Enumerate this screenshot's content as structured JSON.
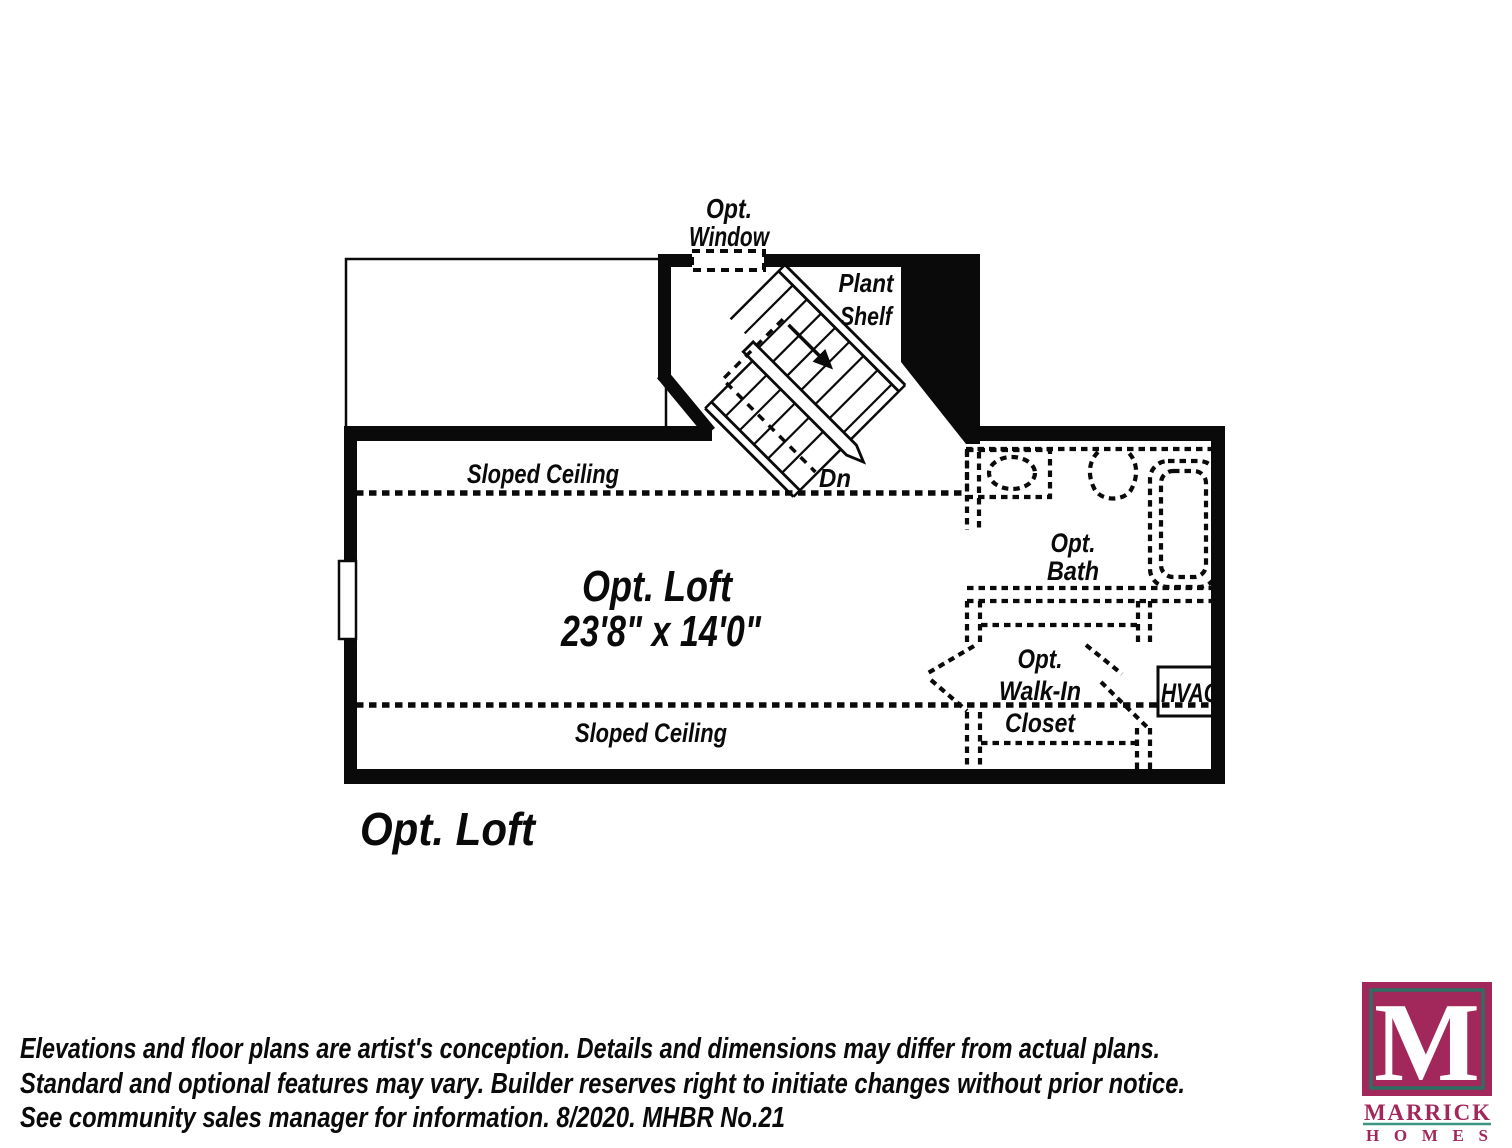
{
  "ink_color": "#0a0a0a",
  "plan": {
    "sheet_title": "Opt. Loft",
    "room": {
      "name": "Opt. Loft",
      "dimensions": "23'8\" x 14'0\""
    },
    "labels": {
      "opt_window_line1": "Opt.",
      "opt_window_line2": "Window",
      "plant_shelf_line1": "Plant",
      "plant_shelf_line2": "Shelf",
      "sloped_ceiling_top": "Sloped Ceiling",
      "sloped_ceiling_bottom": "Sloped Ceiling",
      "stair_down": "Dn",
      "bath_line1": "Opt.",
      "bath_line2": "Bath",
      "closet_line1": "Opt.",
      "closet_line2": "Walk-In",
      "closet_line3": "Closet",
      "hvac": "HVAC"
    }
  },
  "disclaimer": {
    "line1": "Elevations and floor plans are artist's conception. Details and dimensions may differ from actual plans.",
    "line2": "Standard and optional features may vary. Builder reserves right to initiate changes without prior notice.",
    "line3": "See community sales manager for information. 8/2020. MHBR No.21"
  },
  "logo": {
    "monogram": "M",
    "brand": "MARRICK",
    "brand_sub": "HOMES",
    "colors": {
      "magenta": "#A2275B",
      "teal": "#2E6F63",
      "underline": "#3C9483"
    }
  }
}
